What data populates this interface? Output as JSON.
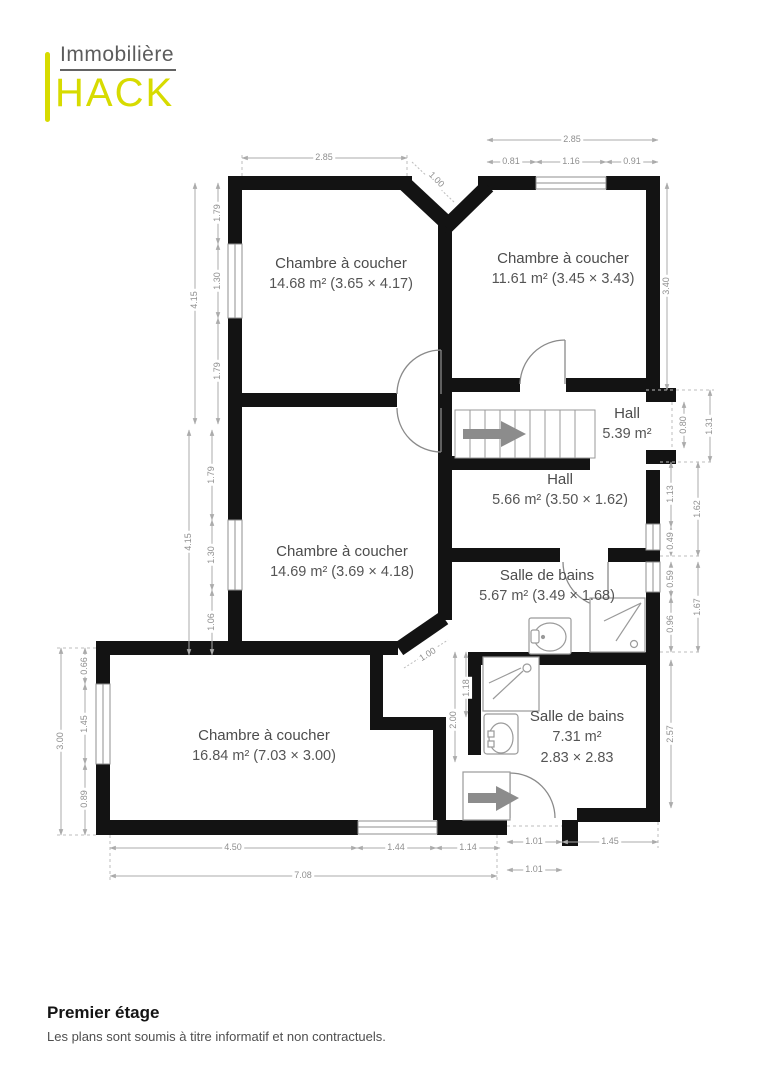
{
  "brand": {
    "line1": "Immobilière",
    "line2": "HACK"
  },
  "footer": {
    "title": "Premier étage",
    "disclaimer": "Les plans sont soumis à titre informatif et non contractuels."
  },
  "colors": {
    "accent_yellow": "#d7db00",
    "wall_black": "#131313",
    "dimension_gray": "#8f8f8f",
    "label_gray": "#4c4c4c"
  },
  "rooms": {
    "r1": {
      "name": "Chambre à coucher",
      "area": "14.68 m² (3.65 × 4.17)"
    },
    "r2": {
      "name": "Chambre à coucher",
      "area": "11.61 m² (3.45 × 3.43)"
    },
    "hall1": {
      "name": "Hall",
      "area": "5.39 m²"
    },
    "hall2": {
      "name": "Hall",
      "area": "5.66 m² (3.50 × 1.62)"
    },
    "r3": {
      "name": "Chambre à coucher",
      "area": "14.69 m² (3.69 × 4.18)"
    },
    "sdb1": {
      "name": "Salle de bains",
      "area": "5.67 m² (3.49 × 1.68)"
    },
    "r4": {
      "name": "Chambre à coucher",
      "area": "16.84 m² (7.03 × 3.00)"
    },
    "sdb2": {
      "name": "Salle de bains",
      "area": "7.31 m²",
      "area2": "2.83 × 2.83"
    }
  },
  "dimensions": [
    {
      "text": "2.85",
      "x": 324,
      "y": 158,
      "rot": 0
    },
    {
      "text": "1.00",
      "x": 436,
      "y": 180,
      "rot": 45
    },
    {
      "text": "2.85",
      "x": 572,
      "y": 140,
      "rot": 0
    },
    {
      "text": "0.81",
      "x": 511,
      "y": 162,
      "rot": 0
    },
    {
      "text": "1.16",
      "x": 571,
      "y": 162,
      "rot": 0
    },
    {
      "text": "0.91",
      "x": 632,
      "y": 162,
      "rot": 0
    },
    {
      "text": "4.15",
      "x": 195,
      "y": 300,
      "rot": -90
    },
    {
      "text": "1.79",
      "x": 218,
      "y": 213,
      "rot": -90
    },
    {
      "text": "1.30",
      "x": 218,
      "y": 281,
      "rot": -90
    },
    {
      "text": "1.79",
      "x": 218,
      "y": 371,
      "rot": -90
    },
    {
      "text": "4.15",
      "x": 189,
      "y": 542,
      "rot": -90
    },
    {
      "text": "1.79",
      "x": 212,
      "y": 475,
      "rot": -90
    },
    {
      "text": "1.30",
      "x": 212,
      "y": 555,
      "rot": -90
    },
    {
      "text": "1.06",
      "x": 212,
      "y": 622,
      "rot": -90
    },
    {
      "text": "3.40",
      "x": 667,
      "y": 286,
      "rot": -90
    },
    {
      "text": "0.80",
      "x": 684,
      "y": 425,
      "rot": -90
    },
    {
      "text": "1.31",
      "x": 710,
      "y": 426,
      "rot": -90
    },
    {
      "text": "1.13",
      "x": 671,
      "y": 494,
      "rot": -90
    },
    {
      "text": "0.49",
      "x": 671,
      "y": 541,
      "rot": -90
    },
    {
      "text": "1.62",
      "x": 698,
      "y": 509,
      "rot": -90
    },
    {
      "text": "0.59",
      "x": 671,
      "y": 579,
      "rot": -90
    },
    {
      "text": "0.96",
      "x": 671,
      "y": 624,
      "rot": -90
    },
    {
      "text": "1.67",
      "x": 698,
      "y": 607,
      "rot": -90
    },
    {
      "text": "2.57",
      "x": 671,
      "y": 734,
      "rot": -90
    },
    {
      "text": "3.00",
      "x": 61,
      "y": 741,
      "rot": -90
    },
    {
      "text": "0.66",
      "x": 85,
      "y": 666,
      "rot": -90
    },
    {
      "text": "1.45",
      "x": 85,
      "y": 724,
      "rot": -90
    },
    {
      "text": "0.89",
      "x": 85,
      "y": 799,
      "rot": -90
    },
    {
      "text": "4.50",
      "x": 233,
      "y": 848,
      "rot": 0
    },
    {
      "text": "1.44",
      "x": 396,
      "y": 848,
      "rot": 0
    },
    {
      "text": "1.14",
      "x": 468,
      "y": 848,
      "rot": 0
    },
    {
      "text": "7.08",
      "x": 303,
      "y": 876,
      "rot": 0
    },
    {
      "text": "1.01",
      "x": 534,
      "y": 842,
      "rot": 0
    },
    {
      "text": "1.45",
      "x": 610,
      "y": 842,
      "rot": 0
    },
    {
      "text": "1.01",
      "x": 534,
      "y": 870,
      "rot": 0
    },
    {
      "text": "1.00",
      "x": 428,
      "y": 655,
      "rot": -32
    },
    {
      "text": "1.18",
      "x": 467,
      "y": 688,
      "rot": -90
    },
    {
      "text": "2.00",
      "x": 454,
      "y": 720,
      "rot": -90
    }
  ]
}
